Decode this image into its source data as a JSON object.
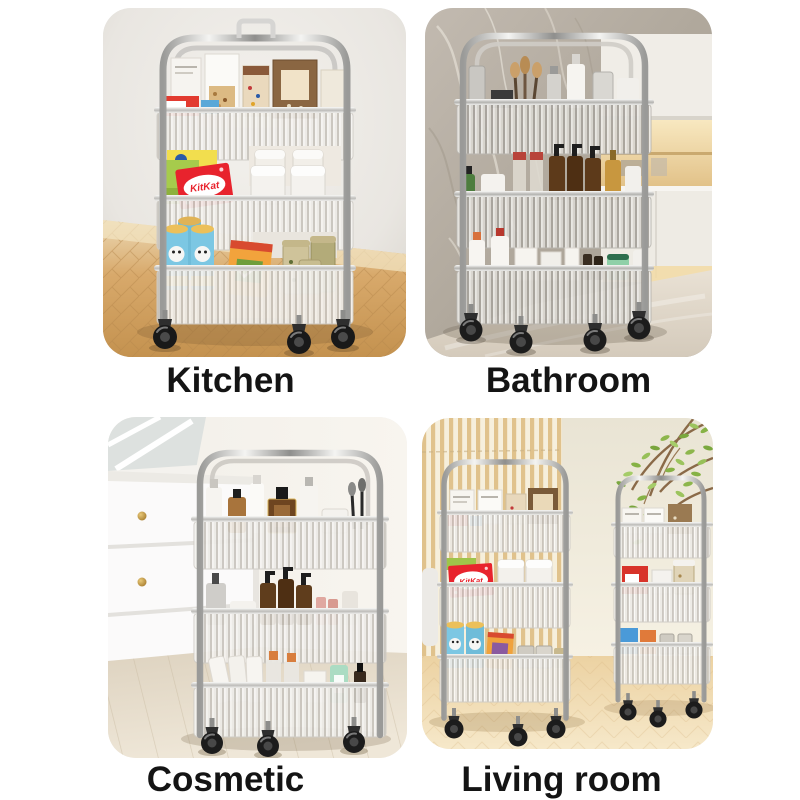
{
  "captions": {
    "kitchen": "Kitchen",
    "bathroom": "Bathroom",
    "cosmetic": "Cosmetic",
    "living_room": "Living room"
  },
  "product_text": {
    "kitkat_kitchen": "KitKat",
    "kitkat_living": "KitKat"
  },
  "colors": {
    "caption_text": "#141414",
    "page_background": "#ffffff",
    "kitkat_red": "#e8232d",
    "chip_can_blue": "#7cc7e3",
    "chip_can_lid_yellow": "#e9b94f",
    "snack_bag_orange": "#f2a33c",
    "amber_bottle_brown": "#5d3a1a",
    "mint_bottle_green": "#9ed8b5",
    "foliage_green": "#8fba4f",
    "kitchen_wood_floor": "#d8a96b",
    "bathroom_marble_gray": "#b6aea3",
    "wallpaper_stripe_tan": "#e0c28c",
    "chrome_silver": "#d9d9d9",
    "wheel_black": "#191919",
    "cabinet_knob_gold": "#c9a23f"
  }
}
